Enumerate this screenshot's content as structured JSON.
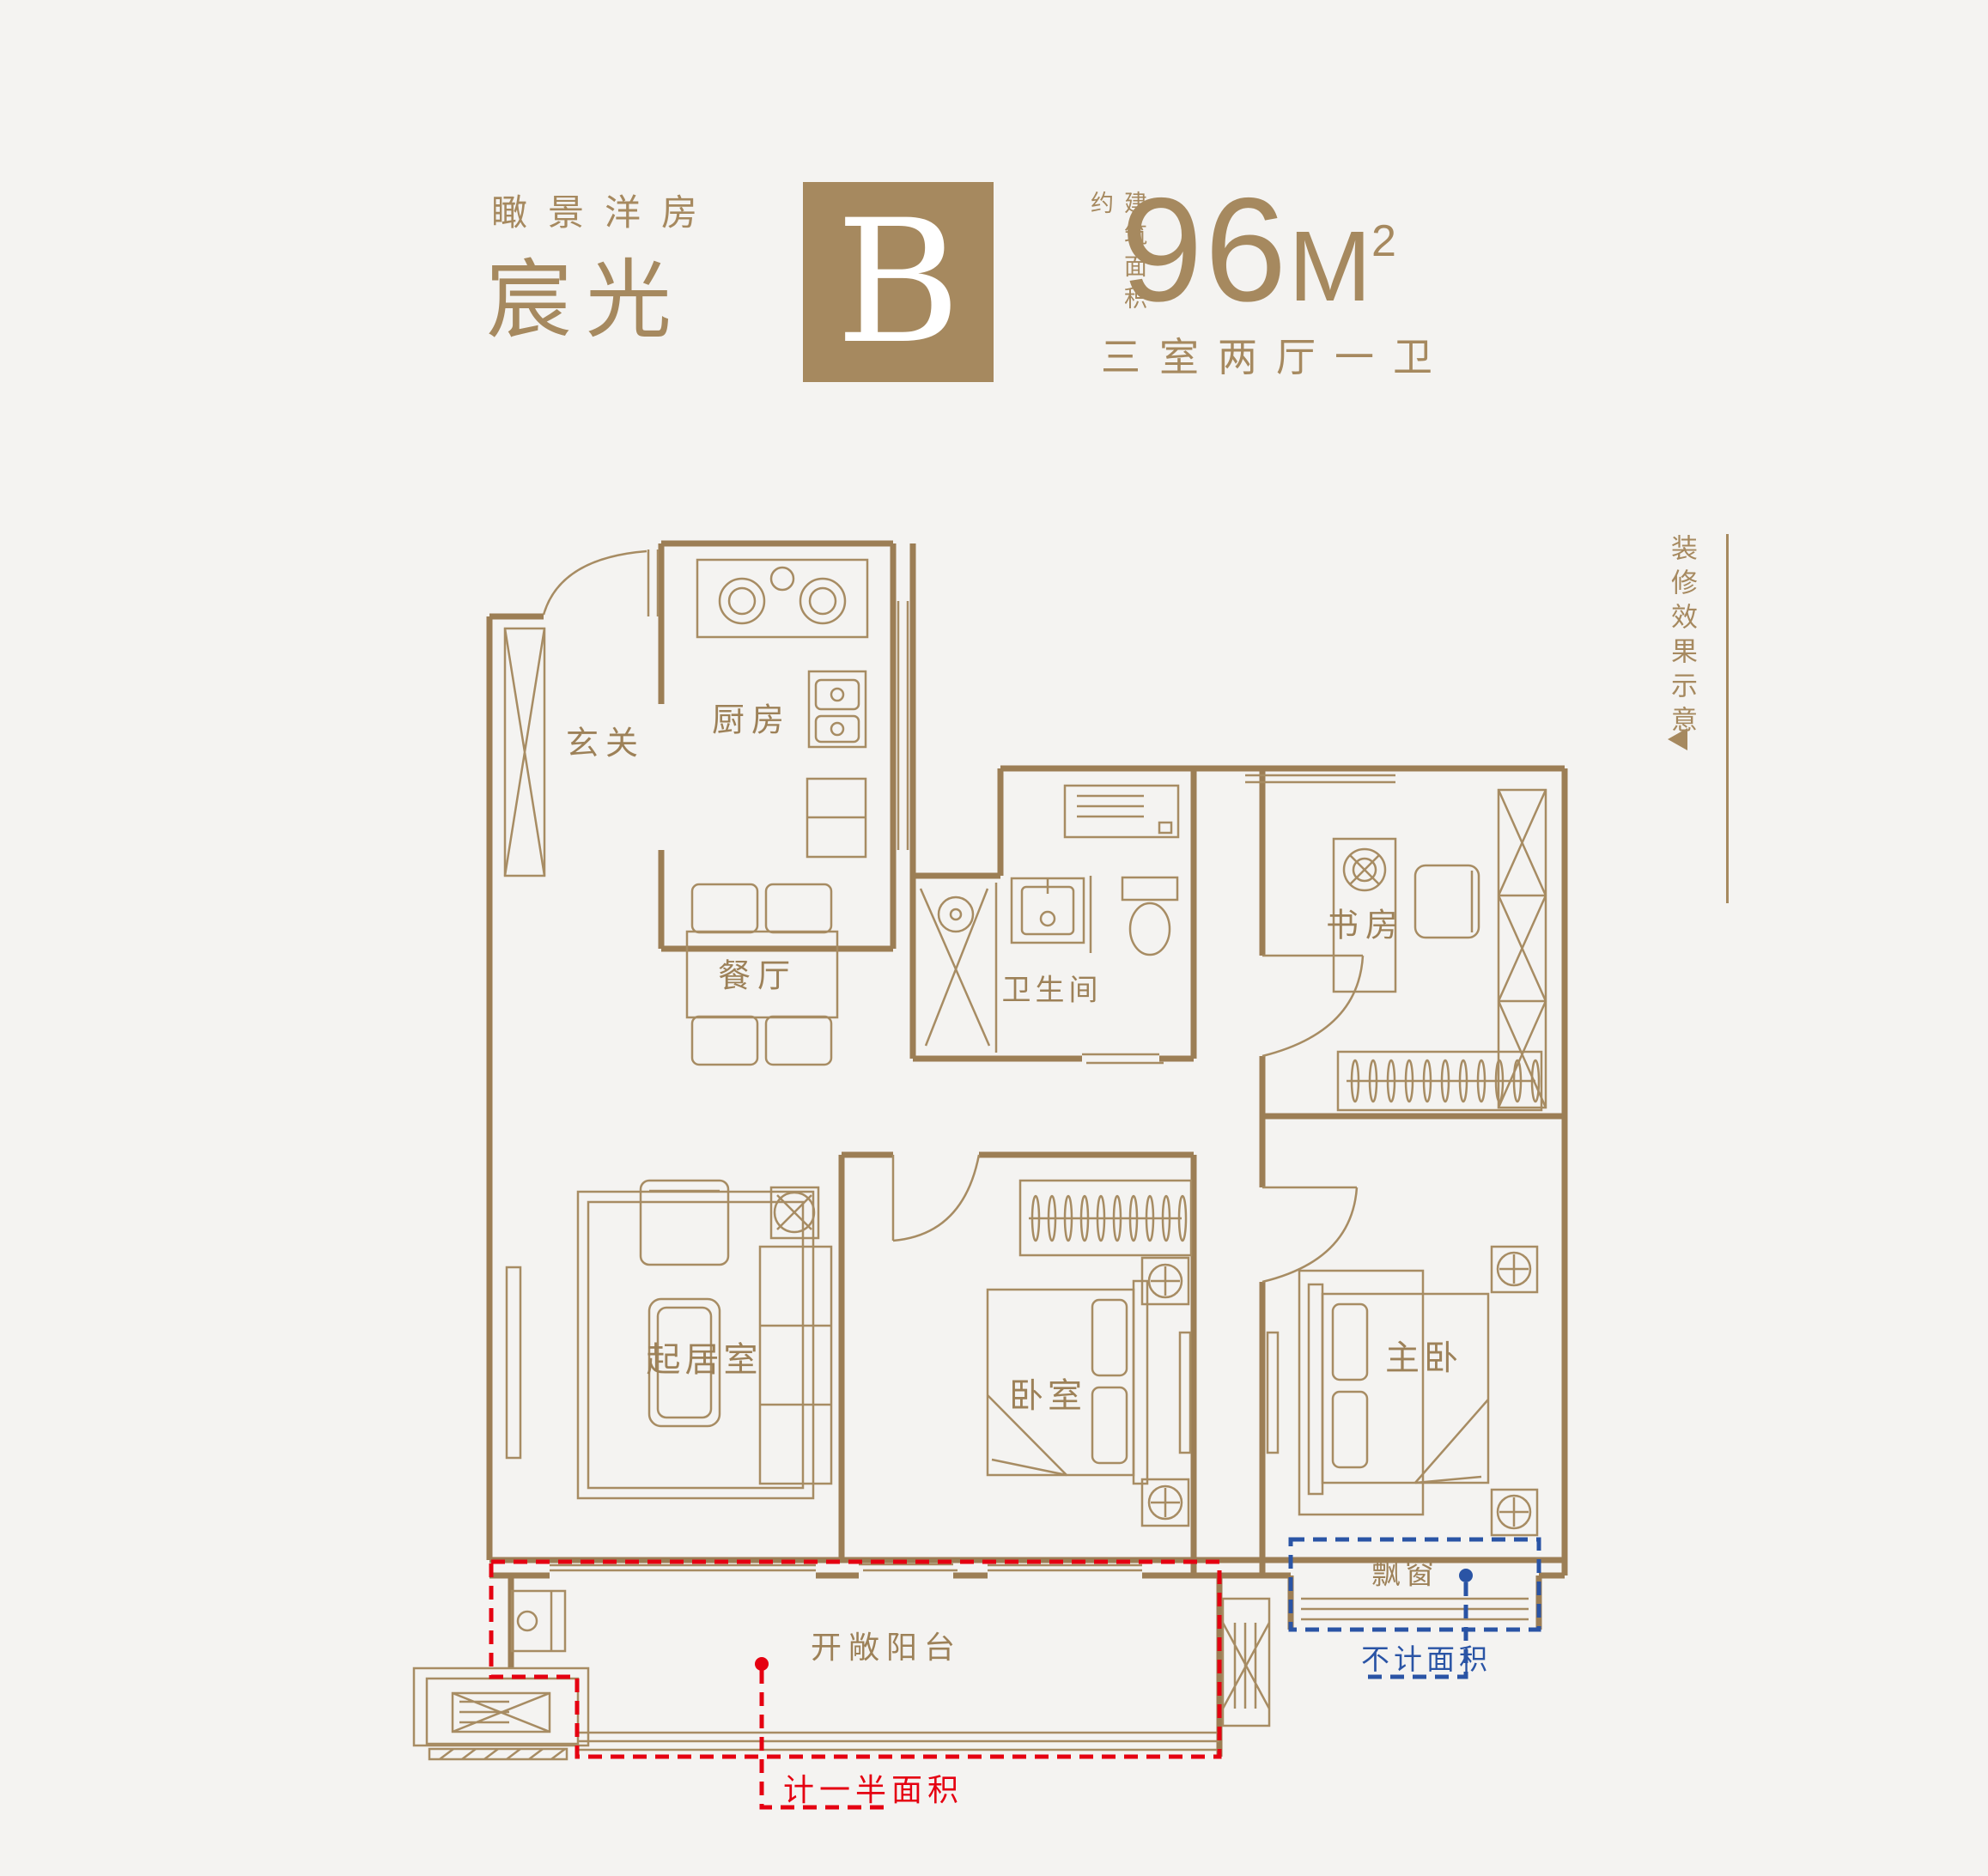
{
  "header": {
    "series_label": "瞰景洋房",
    "name": "宸光",
    "unit_letter": "B",
    "area_prefix": "建筑面积约",
    "area_value": "96",
    "area_unit": "M",
    "area_sup": "2",
    "layout_desc": "三室两厅一卫"
  },
  "side_note": {
    "text": "装修效果示意"
  },
  "rooms": [
    {
      "id": "entry",
      "label": "玄关"
    },
    {
      "id": "kitchen",
      "label": "厨房"
    },
    {
      "id": "dining",
      "label": "餐厅"
    },
    {
      "id": "bathroom",
      "label": "卫生间"
    },
    {
      "id": "study",
      "label": "书房"
    },
    {
      "id": "living",
      "label": "起居室"
    },
    {
      "id": "bedroom",
      "label": "卧室"
    },
    {
      "id": "master",
      "label": "主卧"
    },
    {
      "id": "bay",
      "label": "飘窗"
    },
    {
      "id": "balcony",
      "label": "开敞阳台"
    }
  ],
  "annotations": {
    "half_area": {
      "text": "计一半面积",
      "color": "#e50011"
    },
    "excluded_area": {
      "text": "不计面积",
      "color": "#2a54a5"
    }
  },
  "colors": {
    "background": "#f4f3f1",
    "wall": "#9c7e55",
    "furniture": "#a78c63",
    "accent_brown": "#a6895f",
    "red": "#e50011",
    "blue": "#2a54a5"
  }
}
